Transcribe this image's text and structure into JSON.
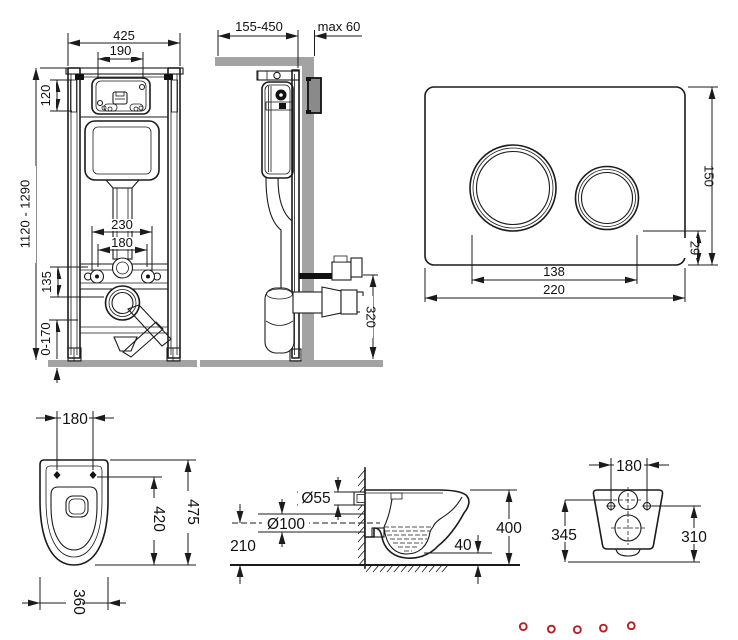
{
  "colors": {
    "line": "#1b1b1b",
    "wall_gray": "#a3a3a3",
    "logo_red": "#d0242b"
  },
  "views": {
    "frame_front": {
      "width": "425",
      "opening_width": "190",
      "opening_height": "120",
      "frame_height": "1120 - 1290",
      "fixing_outer": "230",
      "fixing": "180",
      "drain_offset": "135",
      "foot_adjust": "0-170"
    },
    "frame_side": {
      "depth_range": "155-450",
      "wall_max": "max 60",
      "drain_height": "320"
    },
    "flush_plate": {
      "height": "150",
      "button_offset": "29",
      "button_span": "138",
      "width": "220"
    },
    "bowl_top": {
      "fixing": "180",
      "length": "475",
      "seat_length": "420",
      "width": "360"
    },
    "bowl_side": {
      "inlet_diameter": "Ø55",
      "outlet_diameter": "Ø100",
      "outlet_height": "210",
      "floor_gap": "40",
      "height": "400"
    },
    "bowl_rear": {
      "fixing": "180",
      "left_height": "345",
      "right_height": "310"
    }
  },
  "logo": {
    "letters": [
      "Б",
      "У",
      "Х",
      "Т",
      "А"
    ],
    "color": "#d0242b"
  }
}
